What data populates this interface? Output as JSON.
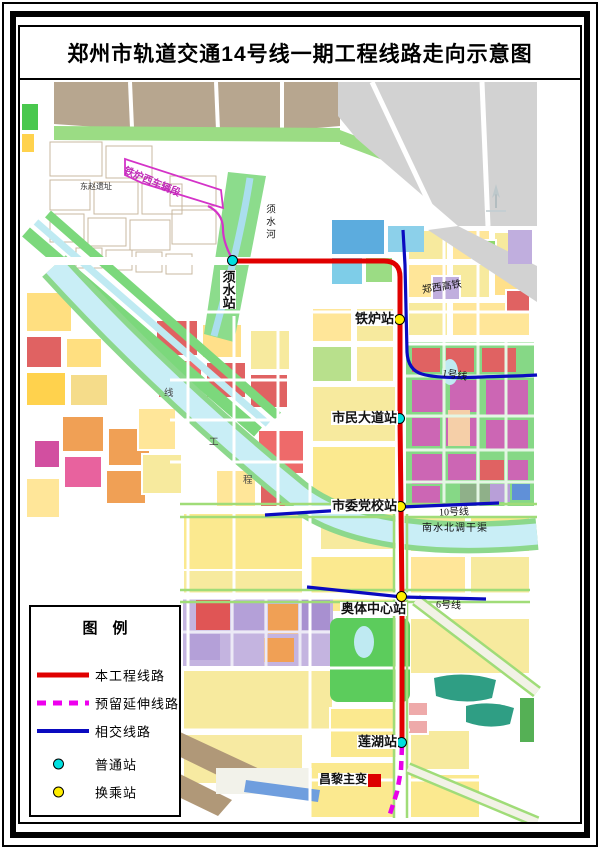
{
  "page": {
    "title": "郑州市轨道交通14号线一期工程线路走向示意图"
  },
  "legend": {
    "title": "图　例",
    "items": [
      {
        "label": "本工程线路",
        "symbol": "red-solid-line",
        "color": "#e00000"
      },
      {
        "label": "预留延伸线路",
        "symbol": "magenta-dashed-line",
        "color": "#ee00ee"
      },
      {
        "label": "相交线路",
        "symbol": "blue-solid-line",
        "color": "#0a0ac0"
      },
      {
        "label": "普通站",
        "symbol": "cyan-station-dot",
        "color": "#00e0e0"
      },
      {
        "label": "换乘站",
        "symbol": "yellow-station-dot",
        "color": "#ffee00"
      }
    ]
  },
  "map": {
    "stations": [
      {
        "name": "须水站",
        "type": "普通站"
      },
      {
        "name": "铁炉站",
        "type": "换乘站"
      },
      {
        "name": "市民大道站",
        "type": "普通站"
      },
      {
        "name": "市委党校站",
        "type": "换乘站"
      },
      {
        "name": "奥体中心站",
        "type": "换乘站"
      },
      {
        "name": "莲湖站",
        "type": "普通站"
      }
    ],
    "features": {
      "depot": "铁炉西车辆段",
      "ruins": "东赵遗址",
      "river": "须水河",
      "high_speed_rail": "郑西高铁",
      "line1": "1号线",
      "line10": "10号线",
      "line6": "6号线",
      "canal": "南水北调干渠",
      "substation": "昌黎主变",
      "canal_chars": [
        "线",
        "工",
        "程"
      ]
    }
  }
}
